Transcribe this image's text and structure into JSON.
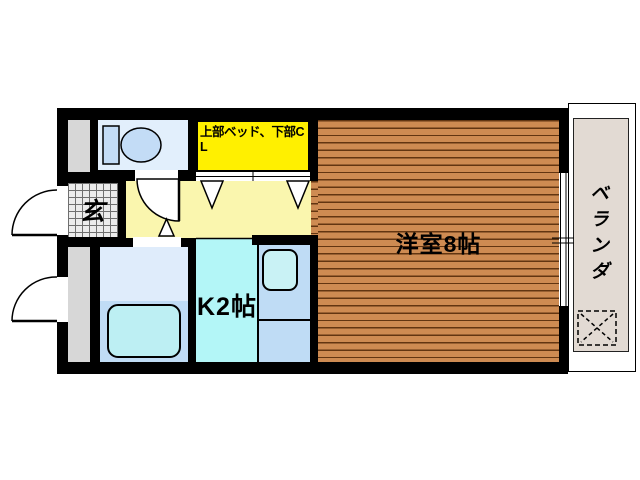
{
  "plan": {
    "rooms": {
      "western_room": {
        "label": "洋室8帖"
      },
      "kitchen": {
        "label": "K2帖"
      },
      "entrance": {
        "label": "玄"
      },
      "veranda": {
        "label": "ベランダ"
      },
      "loft_bed_closet": {
        "label": "上部ベッド、下部CL"
      }
    },
    "fixture_icons": [
      "toilet-icon",
      "bathtub-icon",
      "kitchen-sink-icon",
      "door-swing-icon",
      "folding-door-triangle-icon",
      "window-icon",
      "washer-pan-icon"
    ],
    "colors": {
      "wall": "#000000",
      "wood_floor": "#CE8B52",
      "wood_plank_line": "#623511",
      "hallway_floor": "#FAF6AE",
      "closet_highlight": "#FFF000",
      "kitchen_floor": "#B3F6F7",
      "counter": "#BFDCF5",
      "sink": "#C9F2F5",
      "bath_upper_floor": "#DFECFB",
      "bath_lower_floor": "#C0DCF5",
      "bathtub": "#BDEFF3",
      "toilet_room_floor": "#E2EFFC",
      "toilet_fixture": "#C3DCF6",
      "entrance_tile": "#ECECEC",
      "service_area_gray": "#D7D7D7",
      "veranda_floor": "#E2DAD3"
    }
  }
}
